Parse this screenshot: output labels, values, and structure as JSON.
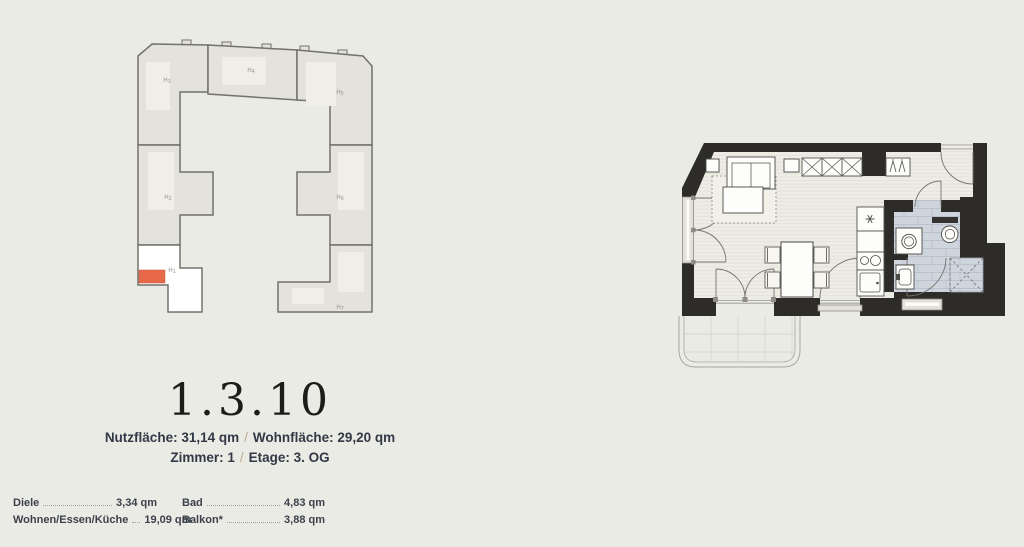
{
  "header": {
    "unit_number": "1.3.10"
  },
  "details": {
    "line1_part1": "Nutzfläche: 31,14 qm",
    "line1_sep": "/",
    "line1_part2": "Wohnfläche: 29,20 qm",
    "line2_part1": "Zimmer: 1",
    "line2_sep": "/",
    "line2_part2": "Etage: 3. OG"
  },
  "site_plan": {
    "highlight_color": "#e8694a",
    "houses": [
      {
        "prefix": "H",
        "num": "3"
      },
      {
        "prefix": "H",
        "num": "4"
      },
      {
        "prefix": "H",
        "num": "5"
      },
      {
        "prefix": "H",
        "num": "2"
      },
      {
        "prefix": "H",
        "num": "6"
      },
      {
        "prefix": "H",
        "num": "1"
      },
      {
        "prefix": "H",
        "num": "7"
      }
    ]
  },
  "rooms": {
    "col1": [
      {
        "name": "Diele",
        "area": "3,34 qm"
      },
      {
        "name": "Wohnen/Essen/Küche",
        "area": "19,09 qm"
      }
    ],
    "col2": [
      {
        "name": "Bad",
        "area": "4,83 qm"
      },
      {
        "name": "Balkon*",
        "area": "3,88 qm"
      }
    ]
  },
  "colors": {
    "background": "#ebebe5",
    "wall": "#2d2c28",
    "tile": "#cfd5dd",
    "accent": "#e8694a"
  }
}
